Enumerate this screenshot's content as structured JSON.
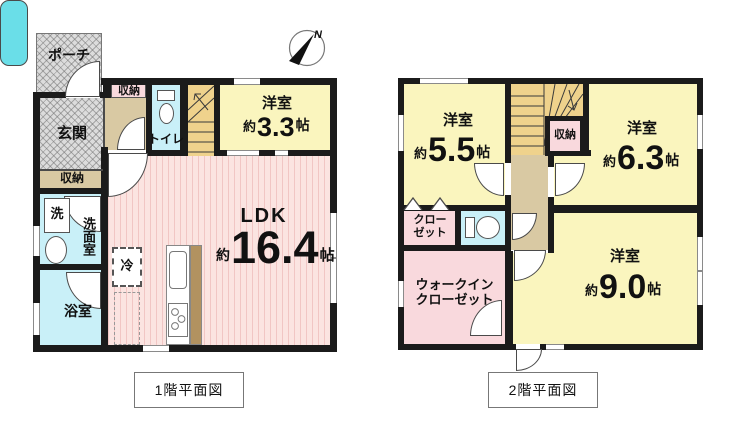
{
  "compass": {
    "north": "N"
  },
  "floor1": {
    "caption": "1階平面図",
    "porch": "ポーチ",
    "entrance": "玄関",
    "entrance_storage": "収納",
    "hall_storage": "収納",
    "toilet": "トイレ",
    "washer": "洗",
    "washroom": "洗面室",
    "fridge": "冷",
    "bathroom": "浴室",
    "western_room": {
      "name": "洋室",
      "approx": "約",
      "size": "3.3",
      "unit": "帖"
    },
    "ldk": {
      "name": "LDK",
      "approx": "約",
      "size": "16.4",
      "unit": "帖"
    }
  },
  "floor2": {
    "caption": "2階平面図",
    "storage": "収納",
    "closet": {
      "line1": "クロー",
      "line2": "ゼット"
    },
    "walkin_closet": {
      "line1": "ウォークイン",
      "line2": "クローゼット"
    },
    "western_room_55": {
      "name": "洋室",
      "approx": "約",
      "size": "5.5",
      "unit": "帖"
    },
    "western_room_63": {
      "name": "洋室",
      "approx": "約",
      "size": "6.3",
      "unit": "帖"
    },
    "western_room_90": {
      "name": "洋室",
      "approx": "約",
      "size": "9.0",
      "unit": "帖"
    }
  },
  "colors": {
    "wall": "#1b1b1b",
    "room_yellow": "#faf5be",
    "room_pink": "#f9d9dd",
    "ldk_pink": "#fbe4e1",
    "hall_tan": "#d9c9a3",
    "stairs_gold": "#efd28c",
    "water_cyan": "#c9f0f8",
    "tub_teal": "#6adee8",
    "entry_gray": "#dcdcdc",
    "kitchen_brown": "#b29260"
  }
}
